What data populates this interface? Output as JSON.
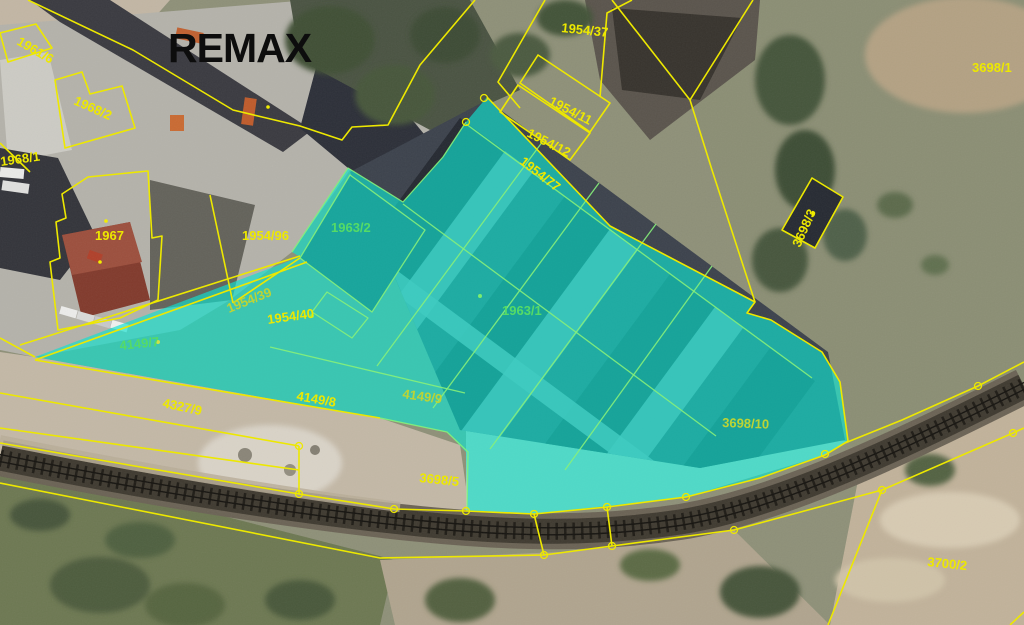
{
  "branding": {
    "logo_text": "REMAX",
    "logo_color": "#0D0D0D"
  },
  "map": {
    "kind": "cadastral-aerial-photo",
    "colors": {
      "boundary_line": "#EDE800",
      "inner_boundary_line": "#86EF7A",
      "label_yellow": "#EDE800",
      "label_olive": "#BCD435",
      "label_green": "#55DB66",
      "highlight_fill": "#10E0CF"
    },
    "highlight": {
      "labels_inside": [
        "1963/2",
        "1963/1",
        "1954/40",
        "4149/7",
        "4149/9",
        "3698/10"
      ]
    },
    "parcel_labels": [
      {
        "number": "1961/6"
      },
      {
        "number": "1968/2"
      },
      {
        "number": "1968/1"
      },
      {
        "number": "1967"
      },
      {
        "number": "1954/96"
      },
      {
        "number": "1954/39"
      },
      {
        "number": "1954/40"
      },
      {
        "number": "4149/7"
      },
      {
        "number": "4327/9"
      },
      {
        "number": "4149/8"
      },
      {
        "number": "4149/9"
      },
      {
        "number": "3698/5"
      },
      {
        "number": "3698/10"
      },
      {
        "number": "3700/2"
      },
      {
        "number": "3698/1"
      },
      {
        "number": "3698/3"
      },
      {
        "number": "1954/37"
      },
      {
        "number": "1954/11"
      },
      {
        "number": "1954/12"
      },
      {
        "number": "1954/77"
      },
      {
        "number": "1963/2"
      },
      {
        "number": "1963/1"
      }
    ]
  }
}
